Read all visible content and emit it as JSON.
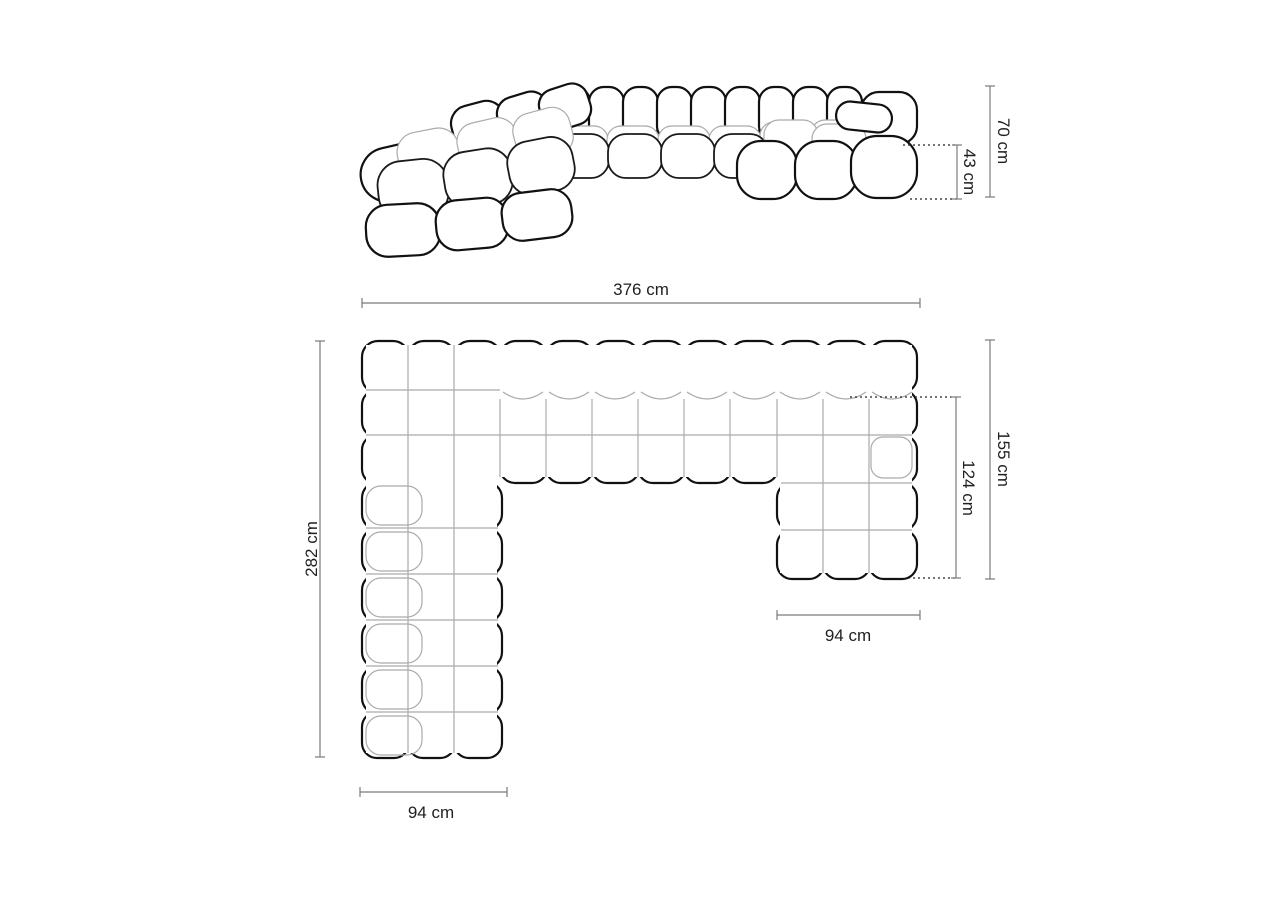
{
  "diagram": {
    "type": "sofa-dimension-drawing",
    "views": {
      "front_view": "perspective view of U-shaped modular sofa",
      "plan_view": "top-down plan of U-shaped modular sofa"
    }
  },
  "dimensions": {
    "back_height": "70 cm",
    "seat_height": "43 cm",
    "total_width": "376 cm",
    "left_side_depth": "282 cm",
    "right_side_depth": "155 cm",
    "chaise_depth": "124 cm",
    "right_module_width": "94 cm",
    "left_module_width": "94 cm"
  },
  "colors": {
    "outline": "#111111",
    "tuft_line": "#ababab",
    "dimension_line": "#7a7a7a",
    "text": "#1f1f1f",
    "background": "#ffffff"
  }
}
